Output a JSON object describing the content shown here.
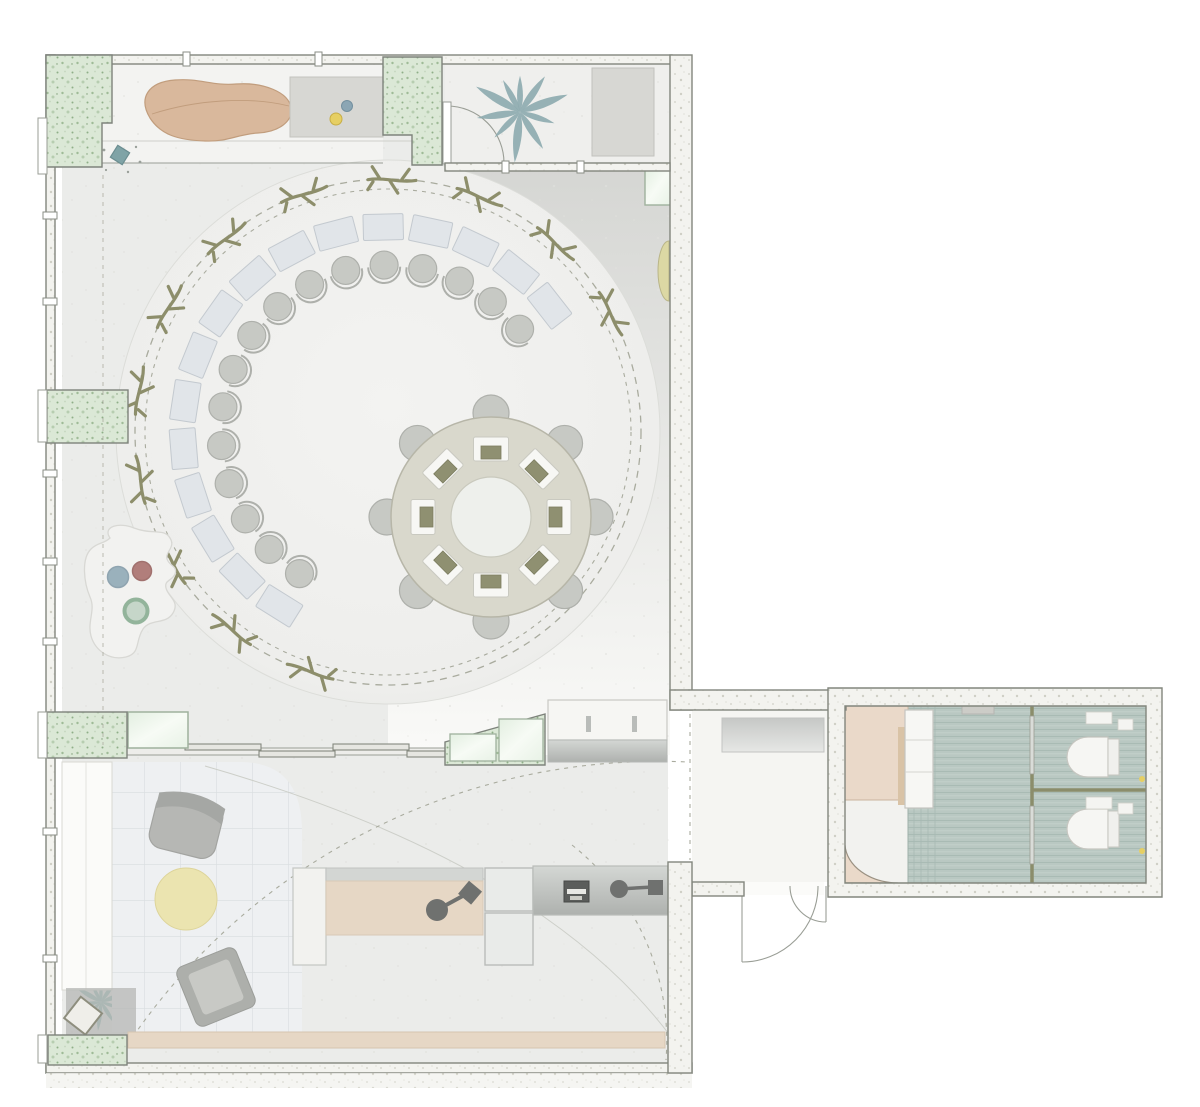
{
  "palette": {
    "floor": "#ebecea",
    "floorLight": "#f3f3f1",
    "plantRoomFloor": "#efefed",
    "wallFill": "#f3f3ef",
    "wallStroke": "#82867d",
    "lineThin": "#9a9e96",
    "dash": "#a9ab9e",
    "marble": "#dbe8d6",
    "marbleDot": "#9fbb97",
    "glass": "#eaf4e8",
    "glassStroke": "#9fb19d",
    "tanSofa": "#d9b89c",
    "tanSofaStroke": "#c19d7d",
    "plant": "#8caaae",
    "grayRug": "#d7d7d3",
    "ring": "#d9d8cc",
    "ringStroke": "#b7b6a8",
    "tableHole": "#eef0ec",
    "desk": "#e1e5e9",
    "deskStroke": "#c3c9cf",
    "chair": "#c7c9c4",
    "chairStroke": "#aeb0ab",
    "twig": "#8d8e6b",
    "equip": "#8f9071",
    "white": "#f8f8f5",
    "bathFloor": "#b9c8c2",
    "bathStripe": "#a9bbb4",
    "bathLight": "#c6d2cc",
    "stall": "#8b8d6b",
    "beigeRoom": "#ead9c9",
    "wood": "#e6d7c5",
    "tile": "#eef0f2",
    "tileLine": "#d9dde0",
    "rugYellow": "#ebe4b0",
    "gray1": "#b6b7b4",
    "gray2": "#c8c9c5",
    "dotYellow": "#e6cf63",
    "dotBlue": "#8ba6b4",
    "dotRed": "#a66a67",
    "dotGreen": "#93b49b",
    "counterA": "#d2d5d2",
    "counterB": "#b2b5b2",
    "lens": "#dcd8a4",
    "dark": "#5b5d5b"
  },
  "plan": {
    "canvas": {
      "w": 1200,
      "h": 1107
    },
    "workshop_ring": {
      "cx": 388,
      "cy": 432,
      "floor_r": 272,
      "dash_r_outer": 253,
      "dash_r_inner": 243,
      "pairs": {
        "count": 16,
        "t_start": -38,
        "sweep": -200,
        "desk_r": 205,
        "desk_w": 40,
        "desk_h": 26,
        "chair_r": 167,
        "chair_rad": 14
      },
      "twigs": {
        "count": 12,
        "t_start": -28,
        "sweep": -224,
        "r": 252
      }
    },
    "round_table": {
      "cx": 491,
      "cy": 517,
      "outer_r": 100,
      "hole_r": 40,
      "stations": {
        "count": 8,
        "t_start": 0,
        "step": 45,
        "r": 68,
        "w": 35,
        "h": 24,
        "equip_w": 20,
        "equip_h": 13
      },
      "chairs": {
        "r_pos": 104,
        "r": 18
      }
    },
    "toilets": [
      {
        "cx": 1096,
        "cy": 757
      },
      {
        "cx": 1096,
        "cy": 829
      }
    ],
    "plants": [
      {
        "x": 520,
        "y": 112,
        "scale": 1.05,
        "color": "#8caaae"
      },
      {
        "x": 101,
        "y": 1002,
        "scale": 0.6,
        "color": "#83b0ad"
      }
    ],
    "counts": {
      "perimeter_desk_chair_pairs": 16,
      "ring_branches": 12,
      "table_workstations": 8,
      "table_chairs": 8,
      "wc_stalls": 2
    }
  }
}
